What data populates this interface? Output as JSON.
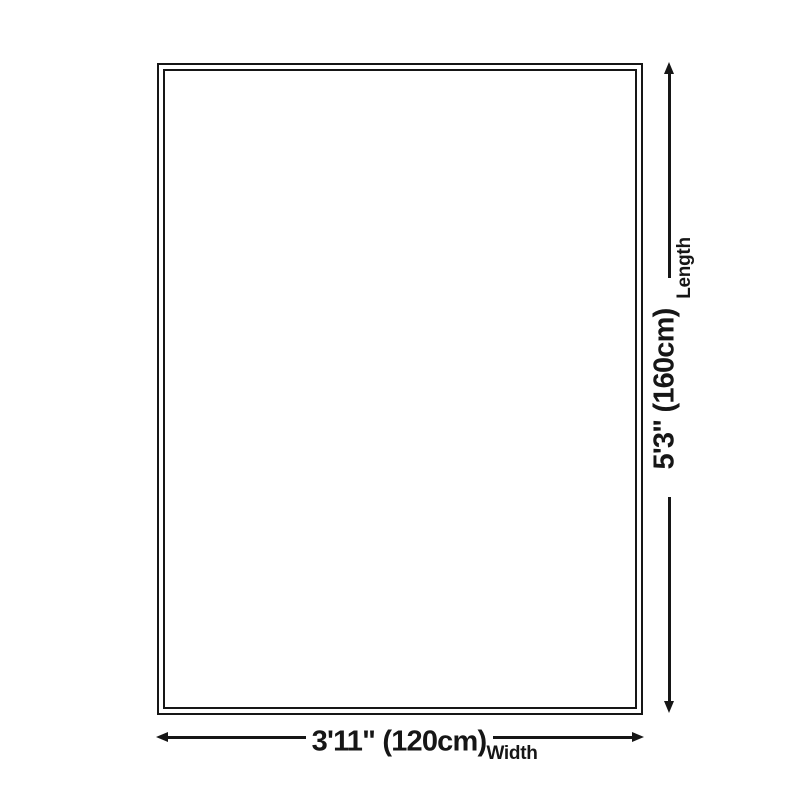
{
  "diagram": {
    "type": "product-size-diagram",
    "length_dimension": {
      "label": "Length",
      "value": "5'3\" (160cm)",
      "orientation": "vertical",
      "side": "right"
    },
    "width_dimension": {
      "label": "Width",
      "value": "3'11\" (120cm)",
      "orientation": "horizontal",
      "side": "bottom"
    }
  },
  "icons": {
    "arrow_up": "triangle-up",
    "arrow_down": "triangle-down",
    "arrow_left": "triangle-left",
    "arrow_right": "triangle-right"
  },
  "colors": {
    "ink": "#161616",
    "background": "#ffffff",
    "surface": "#ffffff"
  }
}
